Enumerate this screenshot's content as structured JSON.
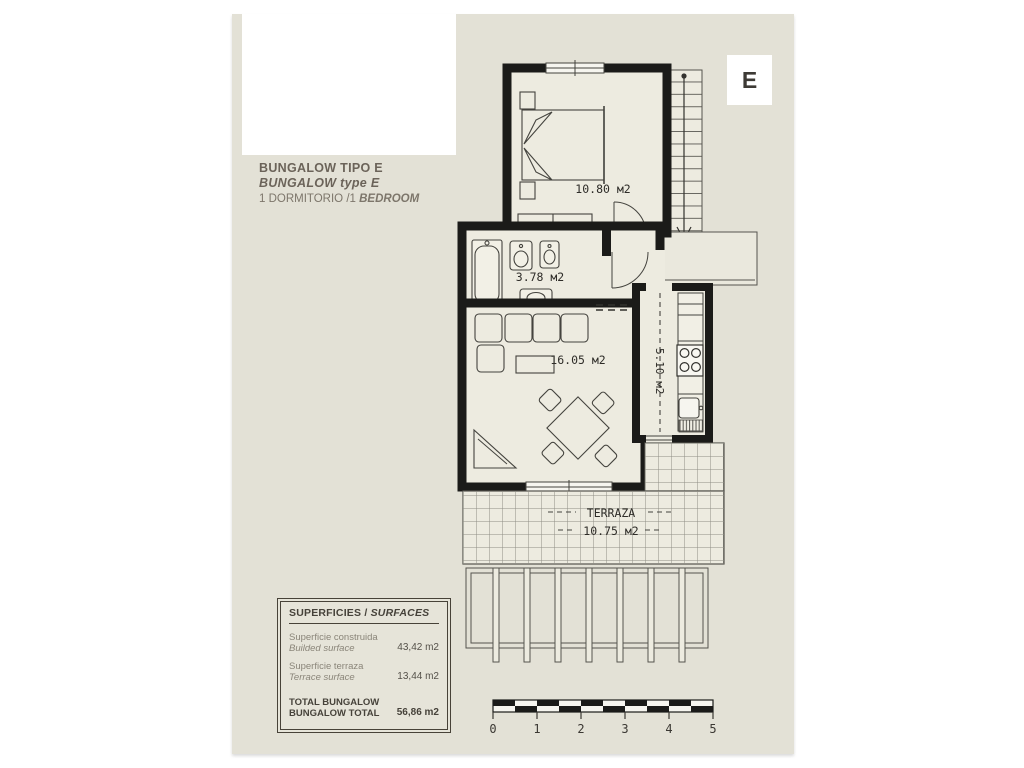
{
  "badge": {
    "letter": "E"
  },
  "title": {
    "line1": "BUNGALOW TIPO E",
    "line2": "BUNGALOW type E",
    "line3_normal": "1 DORMITORIO /1 ",
    "line3_italic": "BEDROOM"
  },
  "rooms": {
    "bedroom_area": "10.80 м2",
    "bathroom_area": "3.78 м2",
    "living_area": "16.05 м2",
    "kitchen_area": "5.10 м2",
    "terrace_name": "TERRAZA",
    "terrace_area": "10.75 м2"
  },
  "surfaces": {
    "header_es": "SUPERFICIES / ",
    "header_en": "SURFACES",
    "rows": [
      {
        "label_es": "Superficie construida",
        "label_en": "Builded surface",
        "value": "43,42 m2"
      },
      {
        "label_es": "Superficie terraza",
        "label_en": "Terrace surface",
        "value": "13,44 m2"
      }
    ],
    "total_label_line1": "TOTAL BUNGALOW",
    "total_label_line2": "BUNGALOW TOTAL",
    "total_value": "56,86 m2"
  },
  "scalebar": {
    "ticks": [
      "0",
      "1",
      "2",
      "3",
      "4",
      "5"
    ]
  },
  "colors": {
    "sheet": "#e3e1d6",
    "floor": "#edebe0",
    "wall": "#1b1b19",
    "line": "#44433e"
  }
}
